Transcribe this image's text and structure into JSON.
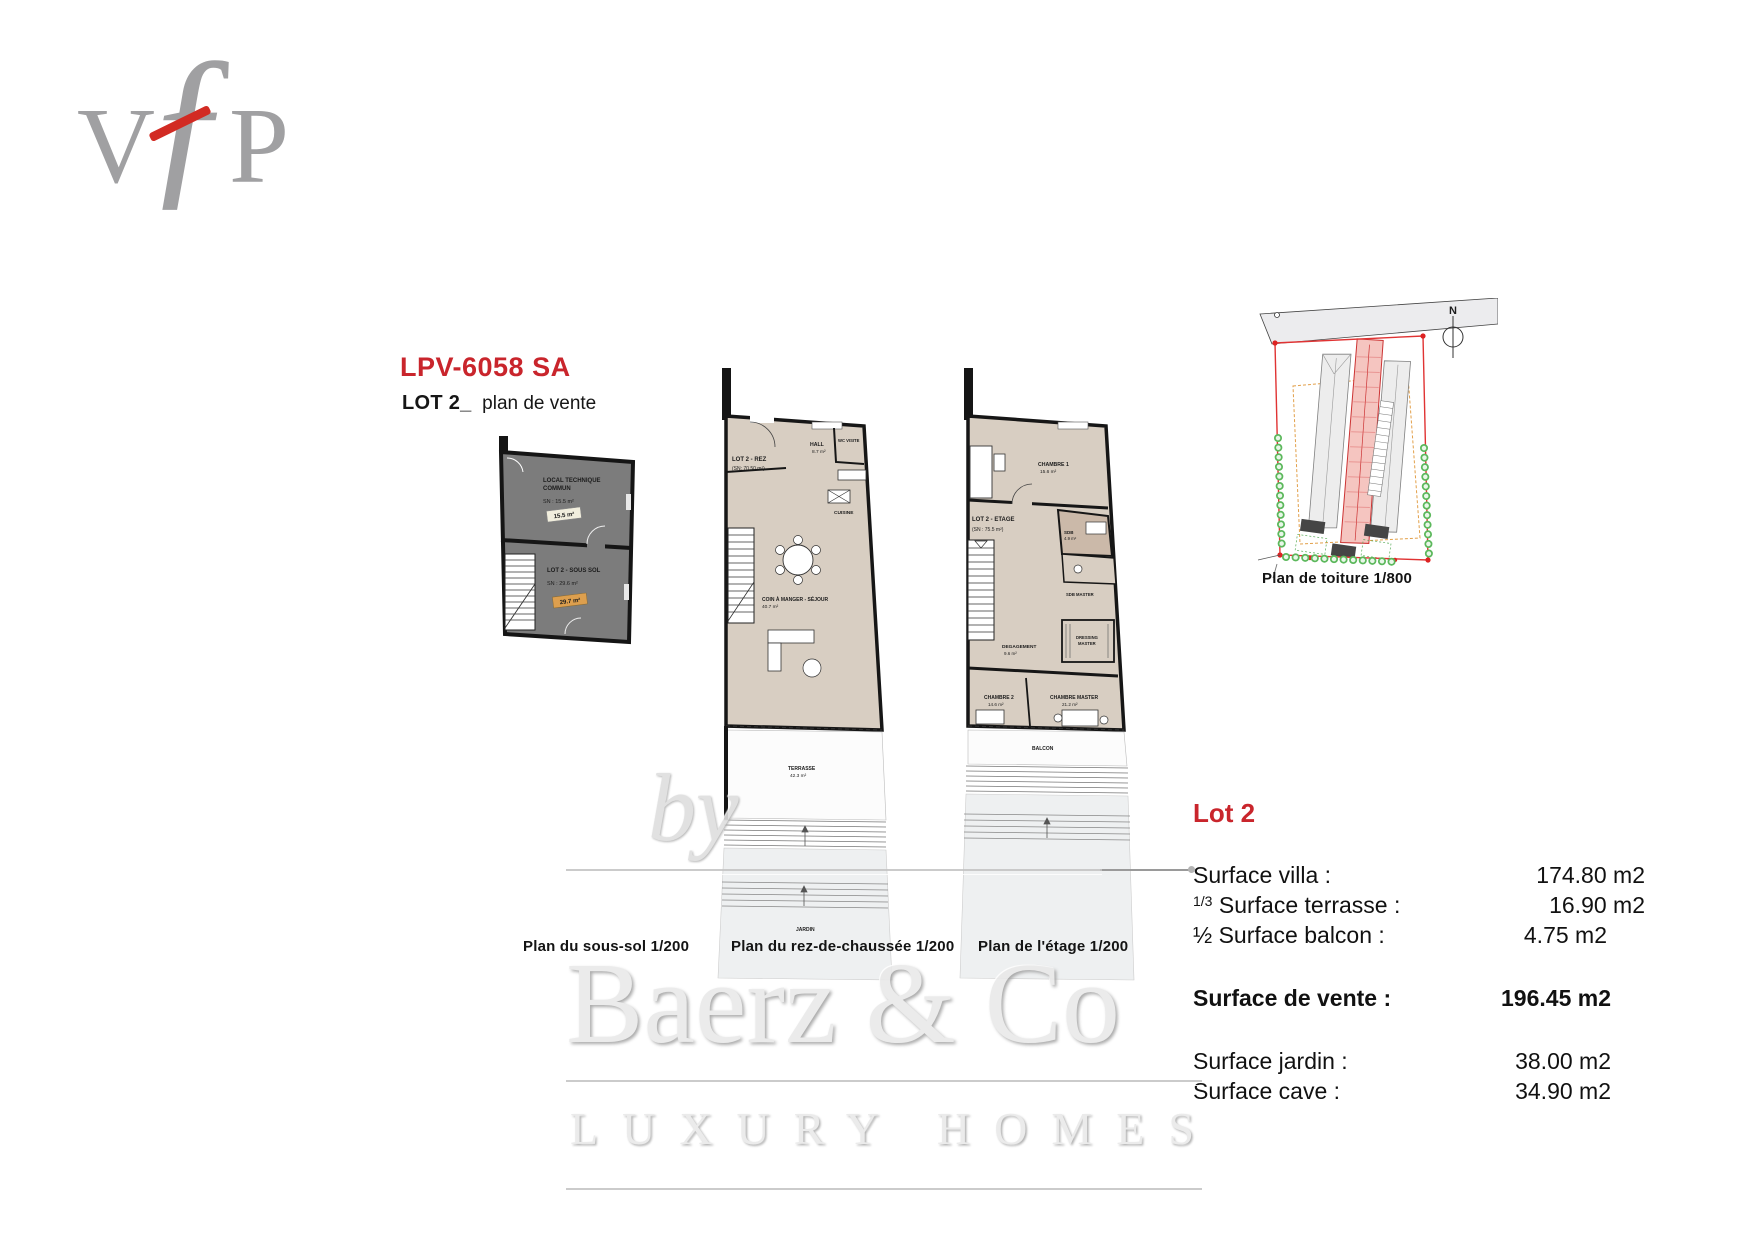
{
  "logo": {
    "v": "V",
    "f": "ƒ",
    "p": "P"
  },
  "header": {
    "reference": "LPV-6058 SA",
    "lot": "LOT 2_",
    "subtitle": "plan de vente"
  },
  "plans": {
    "basement": {
      "caption": "Plan du sous-sol  1/200",
      "room1_name_l1": "LOCAL TECHNIQUE",
      "room1_name_l2": "COMMUN",
      "room1_area": "SN : 15.5 m²",
      "room1_chip": "15.5 m²",
      "room2_name": "LOT 2  - SOUS SOL",
      "room2_area": "SN : 29.6 m²",
      "room2_chip": "29.7 m²"
    },
    "ground": {
      "caption": "Plan du rez-de-chaussée  1/200",
      "lot": "LOT 2 - REZ",
      "lot_area": "(SN: 70.50 m²)",
      "hall": "HALL",
      "hall_area": "8.7 m²",
      "wc": "WC VISITE",
      "kitchen": "CUISINE",
      "living": "COIN À MANGER - SÉJOUR",
      "living_area": "40.7 m²",
      "terrace": "TERRASSE",
      "terrace_area": "42.3 m²",
      "garden": "JARDIN"
    },
    "upper": {
      "caption": "Plan de l'étage  1/200",
      "lot": "LOT 2 - ETAGE",
      "lot_area": "(SN : 75.5 m²)",
      "bedroom1": "CHAMBRE 1",
      "bedroom1_area": "15.6 m²",
      "bath": "SDB",
      "bath_area": "4.9 m²",
      "bath_master": "SDB MASTER",
      "hallway": "DEGAGEMENT",
      "hallway_area": "9.6 m²",
      "dressing_l1": "DRESSING",
      "dressing_l2": "MASTER",
      "bedroom2": "CHAMBRE 2",
      "bedroom2_area": "14.6 m²",
      "master": "CHAMBRE MASTER",
      "master_area": "21.2 m²",
      "balcony": "BALCON"
    },
    "roof": {
      "caption": "Plan de toiture  1/800",
      "north": "N"
    }
  },
  "surface_table": {
    "title": "Lot 2",
    "rows": [
      {
        "prefix": "",
        "label": "Surface villa :",
        "value": "174.80 m2"
      },
      {
        "prefix": "1/3",
        "label": "Surface terrasse :",
        "value": "16.90 m2"
      },
      {
        "prefix": "½ ",
        "label": "Surface balcon :",
        "value": "4.75 m2"
      }
    ],
    "total_label": "Surface de vente :",
    "total_value": "196.45 m2",
    "rows2": [
      {
        "label": "Surface jardin :",
        "value": "38.00 m2"
      },
      {
        "label": "Surface cave :",
        "value": "34.90 m2"
      }
    ]
  },
  "watermark": {
    "by": "by",
    "brand": "Baerz & Co",
    "tagline": "LUXURY HOMES"
  },
  "colors": {
    "accent_red": "#c9252c",
    "beige": "#d8cec2",
    "basement_gray": "#7c7c7c",
    "chip_orange": "#dd9f4e"
  }
}
